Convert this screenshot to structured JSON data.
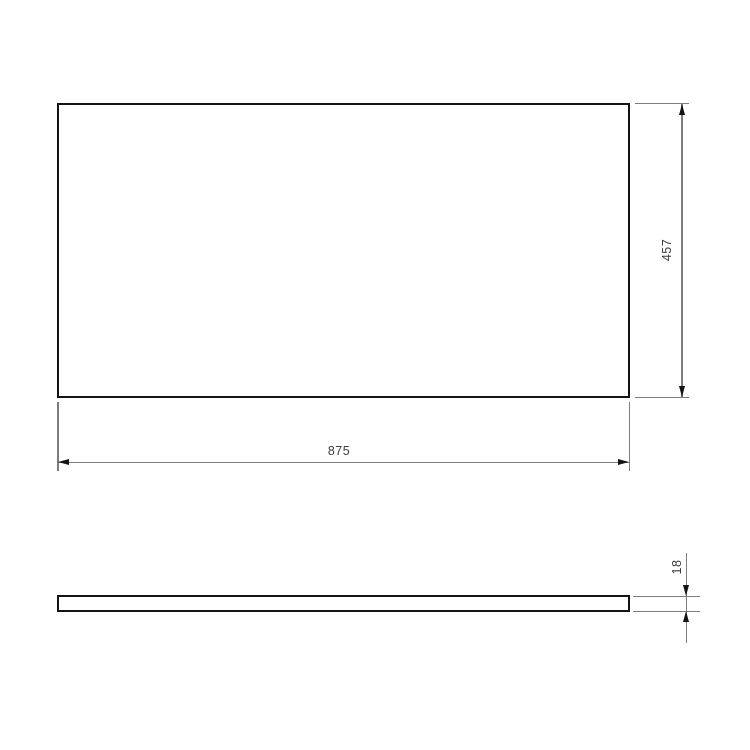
{
  "diagram": {
    "type": "technical-drawing-two-view",
    "front_view": {
      "width_label": "875",
      "height_label": "457"
    },
    "side_view": {
      "thickness_label": "18"
    },
    "colors": {
      "part_outline": "#141414",
      "dimension_line": "#7d7d7d",
      "arrowhead": "#141414",
      "label_text": "#3b3b3b",
      "background": "#ffffff"
    }
  }
}
